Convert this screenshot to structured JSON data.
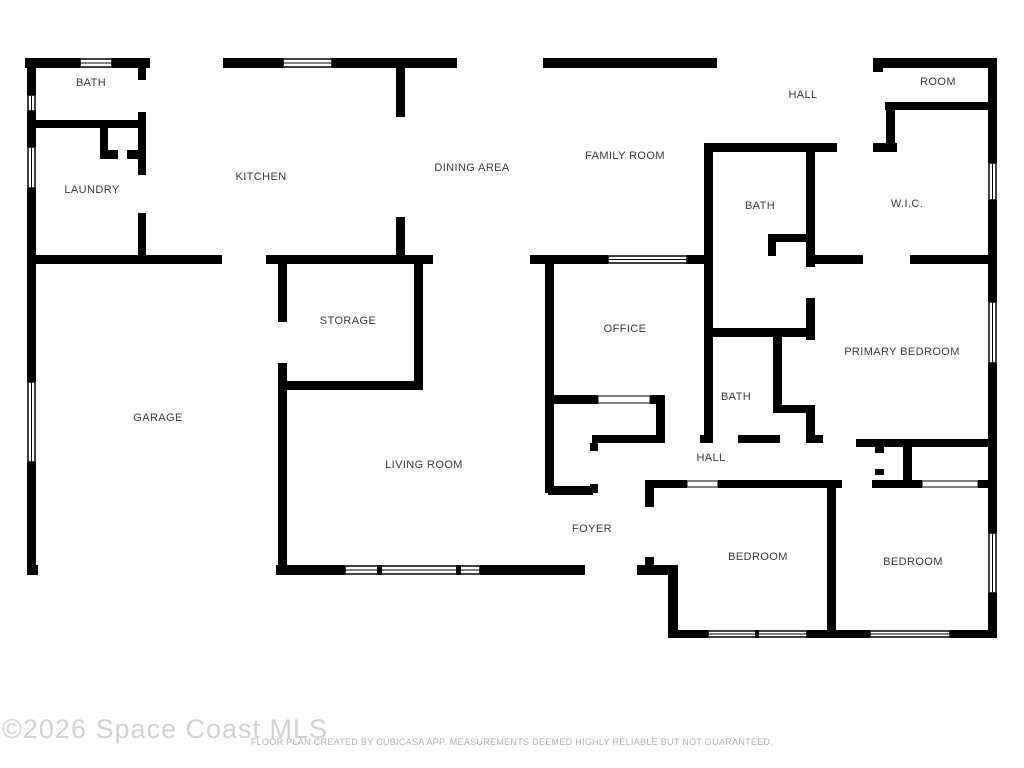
{
  "watermark": "©2026 Space Coast MLS",
  "footer": "FLOOR PLAN CREATED BY CUBICASA APP. MEASUREMENTS DEEMED HIGHLY RELIABLE BUT NOT GUARANTEED.",
  "colors": {
    "wall": "#000000",
    "background": "#ffffff",
    "room_label": "#3a3a3a",
    "watermark": "#d2d2d2",
    "footer_text": "#b2b2b6"
  },
  "rooms": {
    "bath_top": {
      "name": "BATH"
    },
    "laundry": {
      "name": "LAUNDRY"
    },
    "kitchen": {
      "name": "KITCHEN"
    },
    "dining_area": {
      "name": "DINING AREA"
    },
    "family_room": {
      "name": "FAMILY ROOM"
    },
    "hall_top": {
      "name": "HALL"
    },
    "room": {
      "name": "ROOM"
    },
    "wic": {
      "name": "W.I.C."
    },
    "bath_upper": {
      "name": "BATH"
    },
    "storage": {
      "name": "STORAGE"
    },
    "office": {
      "name": "OFFICE"
    },
    "primary_bedroom": {
      "name": "PRIMARY BEDROOM"
    },
    "garage": {
      "name": "GARAGE"
    },
    "bath_lower": {
      "name": "BATH"
    },
    "living_room": {
      "name": "LIVING ROOM"
    },
    "hall_lower": {
      "name": "HALL"
    },
    "foyer": {
      "name": "FOYER"
    },
    "bedroom_left": {
      "name": "BEDROOM"
    },
    "bedroom_right": {
      "name": "BEDROOM"
    }
  }
}
